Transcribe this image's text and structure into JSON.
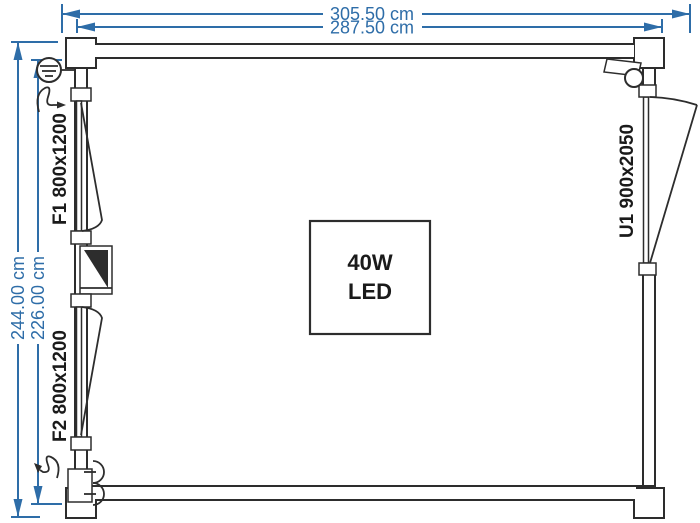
{
  "floorplan": {
    "dims": {
      "outer_width": "305.50 cm",
      "inner_width": "287.50 cm",
      "outer_height": "244.00 cm",
      "inner_height": "226.00 cm"
    },
    "windows": {
      "f1": "F1 800x1200",
      "f2": "F2 800x1200"
    },
    "door": {
      "u1": "U1 900x2050"
    },
    "light": {
      "line1": "40W",
      "line2": "LED"
    },
    "symbols": {
      "top_left": "wall-lamp",
      "top_left_switch": "switch-squiggle",
      "mid_left": "distribution-panel",
      "bottom_left": "double-power-socket",
      "bottom_left_switch": "switch-squiggle",
      "top_right": "exterior-floodlight"
    },
    "colors": {
      "dimension_blue": "#2e6da8",
      "line_dark": "#2d2d2d",
      "background": "#ffffff"
    }
  }
}
